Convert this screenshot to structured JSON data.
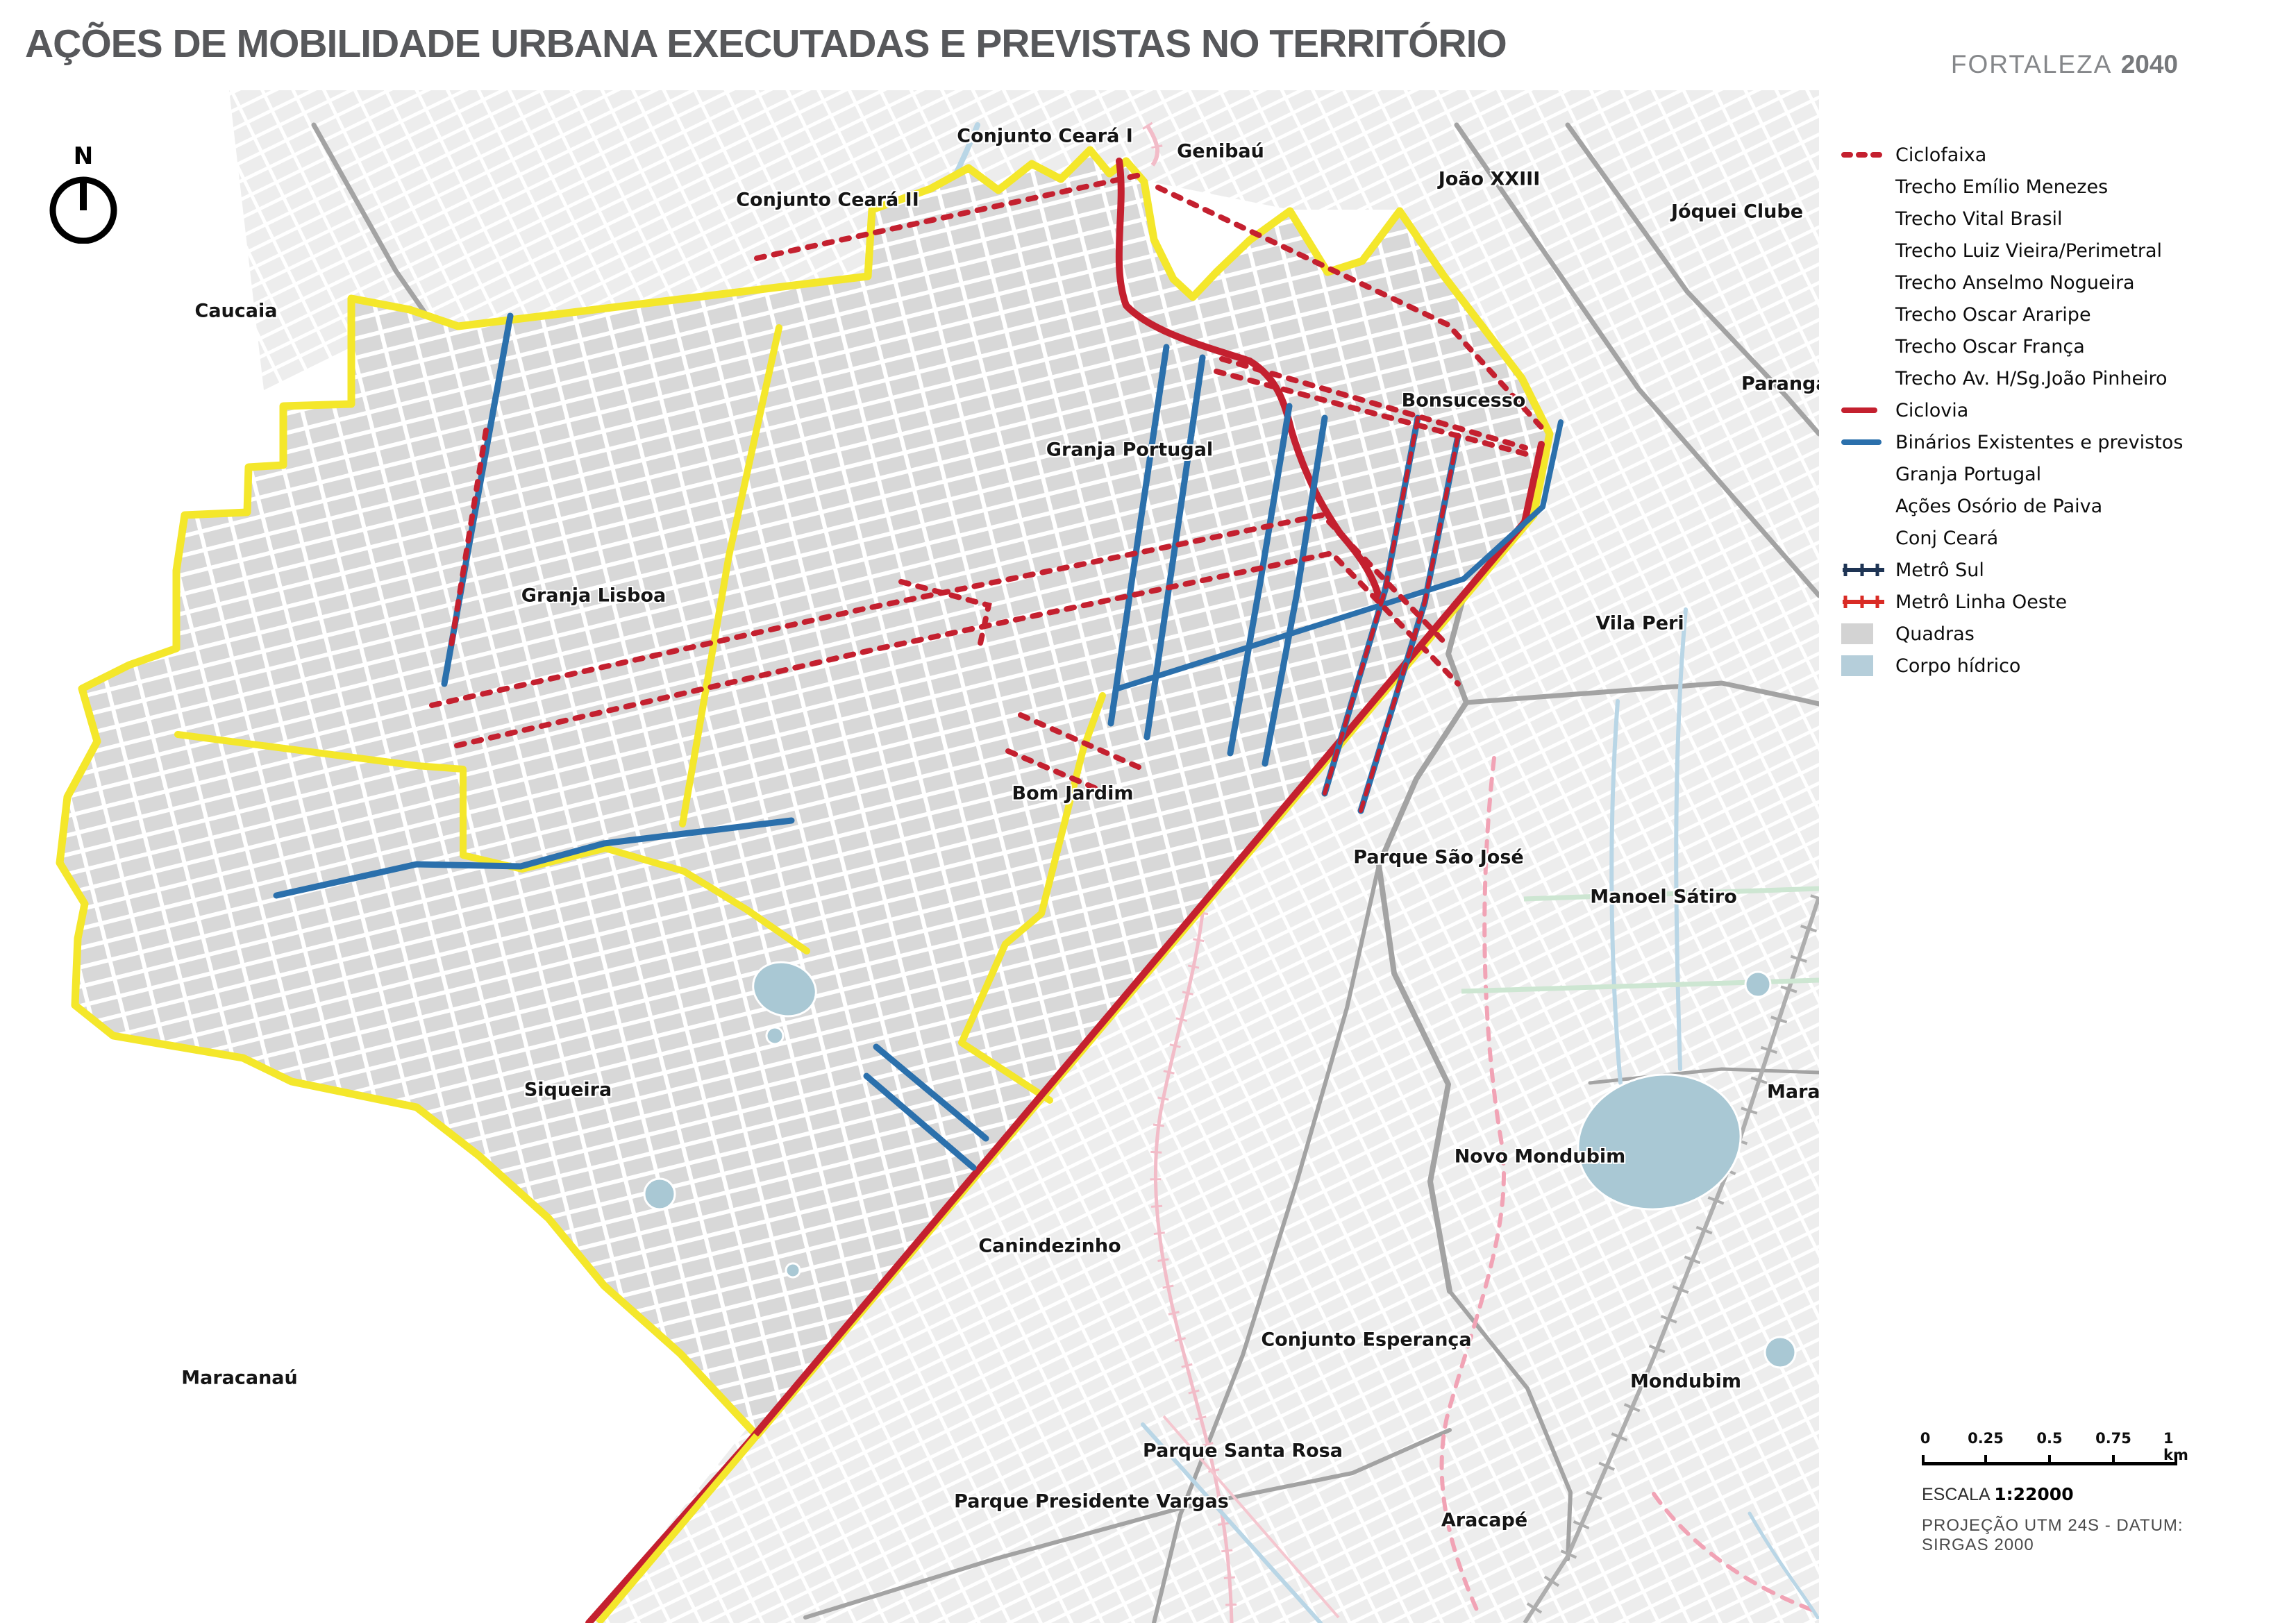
{
  "title": "AÇÕES DE MOBILIDADE URBANA EXECUTADAS E PREVISTAS NO TERRITÓRIO",
  "brand": {
    "name": "FORTALEZA",
    "year": "2040"
  },
  "north": {
    "label": "N"
  },
  "colors": {
    "territory_border": "#F4E72B",
    "ciclofaixa": "#C4202F",
    "ciclovia": "#C4202F",
    "binarios": "#2B70AC",
    "metro_sul": "#1E3454",
    "metro_linha_oeste": "#D92B25",
    "quadras": "#D8D8D8",
    "corpo_hidrico": "#A9C8D4",
    "title_gray": "#57585b"
  },
  "legend": {
    "items": [
      {
        "label": "Ciclofaixa",
        "swatch": "dashed-red"
      },
      {
        "label": "Trecho Emílio Menezes",
        "swatch": "none"
      },
      {
        "label": "Trecho Vital Brasil",
        "swatch": "none"
      },
      {
        "label": "Trecho Luiz Vieira/Perimetral",
        "swatch": "none"
      },
      {
        "label": "Trecho Anselmo Nogueira",
        "swatch": "none"
      },
      {
        "label": "Trecho Oscar Araripe",
        "swatch": "none"
      },
      {
        "label": "Trecho Oscar França",
        "swatch": "none"
      },
      {
        "label": "Trecho Av. H/Sg.João Pinheiro",
        "swatch": "none"
      },
      {
        "label": "Ciclovia",
        "swatch": "solid-red"
      },
      {
        "label": "Binários Existentes e previstos",
        "swatch": "solid-blue"
      },
      {
        "label": "Granja Portugal",
        "swatch": "none"
      },
      {
        "label": "Ações Osório de Paiva",
        "swatch": "none"
      },
      {
        "label": "Conj Ceará",
        "swatch": "none"
      },
      {
        "label": "Metrô Sul",
        "swatch": "metro-navy"
      },
      {
        "label": "Metrô Linha Oeste",
        "swatch": "metro-red"
      },
      {
        "label": "Quadras",
        "swatch": "box-gray"
      },
      {
        "label": "Corpo hídrico",
        "swatch": "box-blue"
      }
    ]
  },
  "map": {
    "labels": [
      {
        "text": "Conjunto Ceará I"
      },
      {
        "text": "Genibaú"
      },
      {
        "text": "João XXIII"
      },
      {
        "text": "Jóquei Clube"
      },
      {
        "text": "Conjunto Ceará II"
      },
      {
        "text": "Caucaia"
      },
      {
        "text": "Parangaba"
      },
      {
        "text": "Bonsucesso"
      },
      {
        "text": "Granja Portugal"
      },
      {
        "text": "Granja Lisboa"
      },
      {
        "text": "Vila Peri"
      },
      {
        "text": "Bom Jardim"
      },
      {
        "text": "Parque São José"
      },
      {
        "text": "Manoel Sátiro"
      },
      {
        "text": "Siqueira"
      },
      {
        "text": "Maraponga"
      },
      {
        "text": "Novo Mondubim"
      },
      {
        "text": "Canindezinho"
      },
      {
        "text": "Conjunto Esperança"
      },
      {
        "text": "Mondubim"
      },
      {
        "text": "Maracanaú"
      },
      {
        "text": "Parque Santa Rosa"
      },
      {
        "text": "Parque Presidente Vargas"
      },
      {
        "text": "Aracapé"
      }
    ]
  },
  "scalebar": {
    "ticks": [
      "0",
      "0.25",
      "0.5",
      "0.75",
      "1 km"
    ],
    "escala_label": "ESCALA",
    "escala_value": "1:22000",
    "projection": "PROJEÇÃO UTM 24S - DATUM: SIRGAS 2000"
  }
}
